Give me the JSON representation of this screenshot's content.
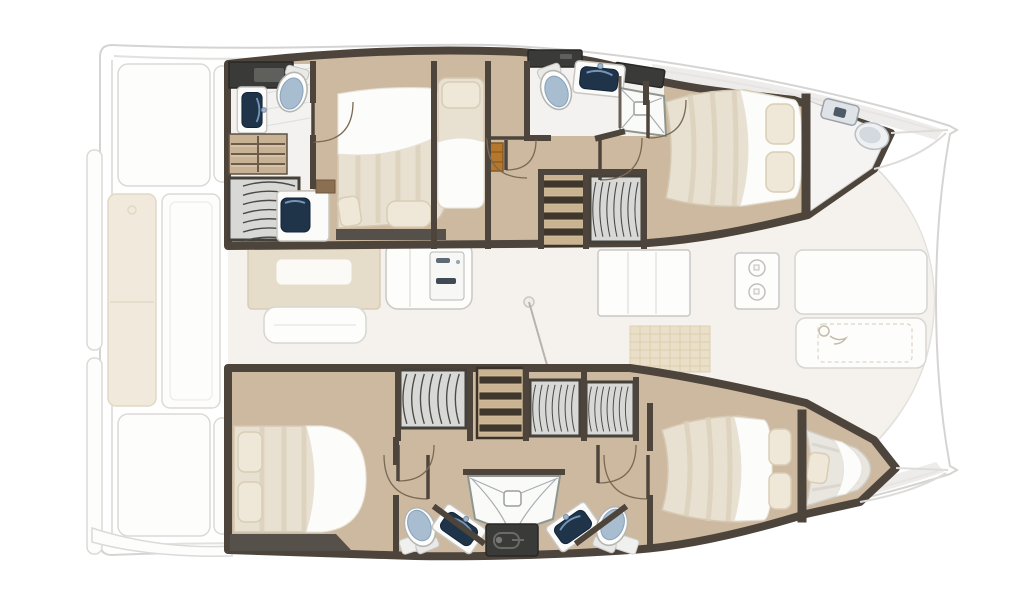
{
  "page": {
    "title": "Catamaran yacht interior layout plan"
  },
  "colors": {
    "background": "#ffffff",
    "outline_faded": "#cecdcb",
    "wall": "#4d443c",
    "wood_floor": "#cdb9a0",
    "tile_floor": "#f3f2f0",
    "nacelle_floor": "#f5f2ed",
    "mattress": "#e8e0d0",
    "sheet": "#fcfcfa",
    "pillow": "#efe8d8",
    "sink_navy": "#1f3448",
    "sink_highlight": "#7da0c4",
    "toilet_lid": "#a9bdd0",
    "cabinet_dark": "#3a3a38",
    "wardrobe_gray": "#d8d8d6",
    "steps_wood": "#c9b391",
    "step_tread": "#40372c",
    "locker_orange": "#b5772b",
    "bench_tan": "#eee6d6",
    "saloon_tan": "#e6dcca",
    "deck_gray": "#e4e2df",
    "bow_berth_gray": "#e9e6e0"
  },
  "floor_plan": {
    "vessel_type": "catamaran",
    "view": "top-down interior deck plan",
    "bow_direction": "right",
    "stern_direction": "left",
    "hulls": {
      "top_hull": {
        "rooms": [
          {
            "room": "aft-head",
            "items": [
              "storage-cabinet",
              "washbasin",
              "toilet",
              "shelf-locker",
              "hanging-wardrobe",
              "vanity-desk",
              "vanity-stool"
            ]
          },
          {
            "room": "aft-double-cabin",
            "items": [
              "double-berth",
              "pillow",
              "pillow",
              "nightstand",
              "door"
            ]
          },
          {
            "room": "single-berth-nook",
            "items": [
              "single-berth",
              "pillow",
              "orange-locker"
            ]
          },
          {
            "room": "mid-head",
            "items": [
              "storage-cabinet",
              "toilet",
              "washbasin",
              "shower-cubicle",
              "door",
              "door"
            ]
          },
          {
            "room": "companionway",
            "items": [
              "steps",
              "hanging-wardrobe",
              "door"
            ]
          },
          {
            "room": "forward-double-cabin",
            "items": [
              "double-berth",
              "pillow",
              "pillow",
              "door"
            ]
          },
          {
            "room": "bow-compartment",
            "items": [
              "hatch",
              "basin"
            ]
          }
        ]
      },
      "bottom_hull": {
        "rooms": [
          {
            "room": "aft-double-cabin",
            "items": [
              "double-berth",
              "pillow",
              "pillow",
              "hanging-wardrobe",
              "door"
            ]
          },
          {
            "room": "companionway",
            "items": [
              "steps",
              "hanging-wardrobe",
              "hanging-wardrobe",
              "door",
              "door"
            ]
          },
          {
            "room": "shared-head",
            "items": [
              "toilet",
              "washbasin",
              "shower-cubicle",
              "cabinet",
              "washbasin",
              "toilet"
            ]
          },
          {
            "room": "forward-double-cabin",
            "items": [
              "double-berth",
              "pillow",
              "pillow",
              "door"
            ]
          },
          {
            "room": "bow-berth",
            "items": [
              "single-berth",
              "pillow"
            ]
          }
        ]
      }
    },
    "center_deck_faded": {
      "saloon": [
        "saloon-table",
        "table-top",
        "sofa",
        "galley-unit",
        "appliance",
        "mast-base"
      ],
      "galley": [
        "counter",
        "stove-two-burners",
        "floor-mat"
      ],
      "foredeck": [
        "deck-panel",
        "sunpad",
        "lounge-icon"
      ],
      "cockpit": [
        "swim-platform",
        "swim-platform",
        "bench-cushion",
        "cockpit-table",
        "deck-panel",
        "deck-panel",
        "helm-seat",
        "deck-panel",
        "deck-panel",
        "helm-seat",
        "stern-step"
      ]
    }
  }
}
